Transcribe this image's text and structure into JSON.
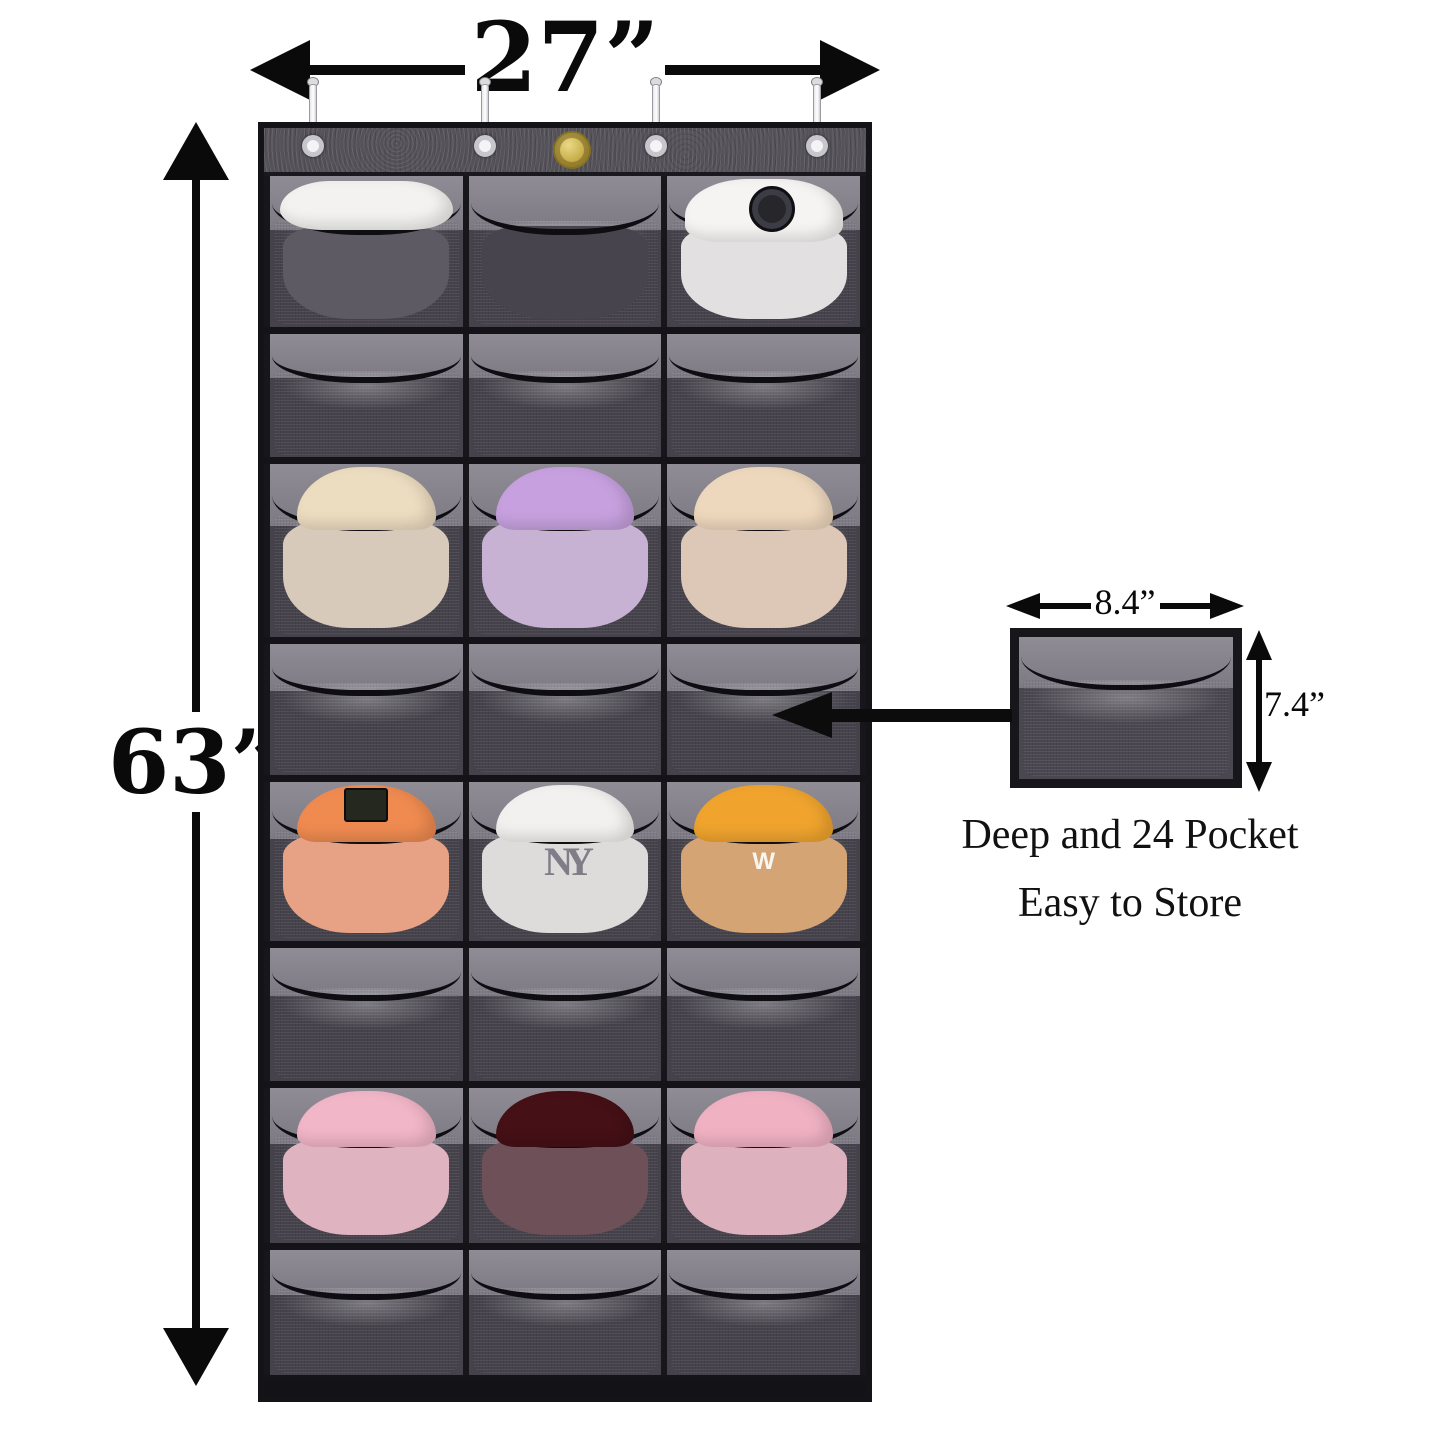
{
  "annotations": {
    "width_label": "27”",
    "height_label": "63”",
    "inset": {
      "pocket_width_label": "8.4”",
      "pocket_height_label": "7.4”",
      "caption_line1": "Deep and 24 Pocket",
      "caption_line2": "Easy to Store"
    }
  },
  "colors": {
    "background": "#ffffff",
    "annotation_black": "#0a0a0a",
    "panel_dark": "#3e3b42",
    "header_band": "#55525a",
    "pocket_mesh_light": "#a8a5ad",
    "pocket_mesh_dark": "#8b8892",
    "trim_black": "#100f13",
    "badge_gold": "#cdb65c"
  },
  "organizer": {
    "hooks": 4,
    "badge": "gold-brand-badge",
    "logo_texts": {
      "ny": "NY",
      "w": "W"
    },
    "rows": [
      {
        "pockets": [
          {
            "item": "white-visor-cap",
            "shape": "visor",
            "crown": "#f3f2f0",
            "body": "#5d5a63",
            "logo": "none"
          },
          {
            "item": "dark-hat",
            "shape": "none",
            "crown": "",
            "body": "#47444d",
            "logo": "none"
          },
          {
            "item": "white-bucket-hat",
            "shape": "bucket",
            "crown": "#f5f4f2",
            "body": "#e2e0e1",
            "logo": "dark-circle"
          }
        ]
      },
      {
        "pockets": [
          {
            "item": "empty"
          },
          {
            "item": "empty"
          },
          {
            "item": "empty"
          }
        ]
      },
      {
        "pockets": [
          {
            "item": "cream-hat",
            "shape": "round",
            "crown": "#ecdcc0",
            "body": "#d8cabb",
            "logo": "none"
          },
          {
            "item": "lavender-hat",
            "shape": "round",
            "crown": "#c7a1df",
            "body": "#c8b2d3",
            "logo": "none"
          },
          {
            "item": "peach-hat",
            "shape": "round",
            "crown": "#eed8bd",
            "body": "#ddc7b6",
            "logo": "none"
          }
        ]
      },
      {
        "pockets": [
          {
            "item": "empty"
          },
          {
            "item": "empty"
          },
          {
            "item": "empty"
          }
        ]
      },
      {
        "pockets": [
          {
            "item": "orange-hat",
            "shape": "round",
            "crown": "#ef8b51",
            "body": "#e7a184",
            "logo": "chip"
          },
          {
            "item": "white-ny-cap",
            "shape": "round",
            "crown": "#f3f1ef",
            "body": "#dedcda",
            "logo": "ny"
          },
          {
            "item": "yellow-hat",
            "shape": "round",
            "crown": "#f0a42e",
            "body": "#d4a474",
            "logo": "w"
          }
        ]
      },
      {
        "pockets": [
          {
            "item": "empty"
          },
          {
            "item": "empty"
          },
          {
            "item": "empty"
          }
        ]
      },
      {
        "pockets": [
          {
            "item": "pink-hat",
            "shape": "round",
            "crown": "#f1b6c8",
            "body": "#dfb3c0",
            "logo": "none"
          },
          {
            "item": "maroon-hat",
            "shape": "round",
            "crown": "#451016",
            "body": "#6d5058",
            "logo": "none"
          },
          {
            "item": "pink-hat",
            "shape": "round",
            "crown": "#f0b2c3",
            "body": "#ddb1be",
            "logo": "none"
          }
        ]
      },
      {
        "pockets": [
          {
            "item": "empty"
          },
          {
            "item": "empty"
          },
          {
            "item": "empty"
          }
        ]
      }
    ]
  }
}
